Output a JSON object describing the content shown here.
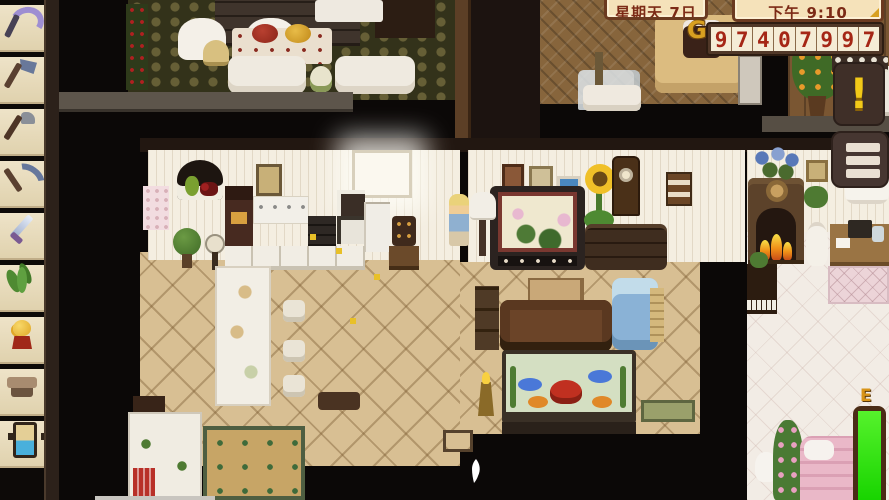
{
  "hud": {
    "date_label": "星期天 7日",
    "time_label": "下午 9:10",
    "gold_amount": "97407997",
    "gold_icon": "G",
    "quest_icon": "!",
    "menu_icon": "hamburger-icon",
    "energy_label": "E",
    "energy_percent": 100,
    "cursor_icon": "white-pointer",
    "colors": {
      "hud_box_fill": "#f5e2ba",
      "hud_box_border": "#6b3a20",
      "hud_text": "#7c2a16",
      "gold_digits": "#a52616",
      "gold_panel": "#513828",
      "quest_exclaim": "#f2c918",
      "energy_fill": "#18d400"
    }
  },
  "sidebar": {
    "items": [
      {
        "name": "toolbar-slot-scythe",
        "icon": "scythe"
      },
      {
        "name": "toolbar-slot-axe",
        "icon": "axe"
      },
      {
        "name": "toolbar-slot-hoe",
        "icon": "hoe"
      },
      {
        "name": "toolbar-slot-pickaxe",
        "icon": "pickaxe"
      },
      {
        "name": "toolbar-slot-sword",
        "icon": "sword"
      },
      {
        "name": "toolbar-slot-fern",
        "icon": "fern"
      },
      {
        "name": "toolbar-slot-chicken-statue",
        "icon": "chicken"
      },
      {
        "name": "toolbar-slot-bench",
        "icon": "bench"
      },
      {
        "name": "toolbar-slot-scroll",
        "icon": "scroll"
      }
    ]
  }
}
